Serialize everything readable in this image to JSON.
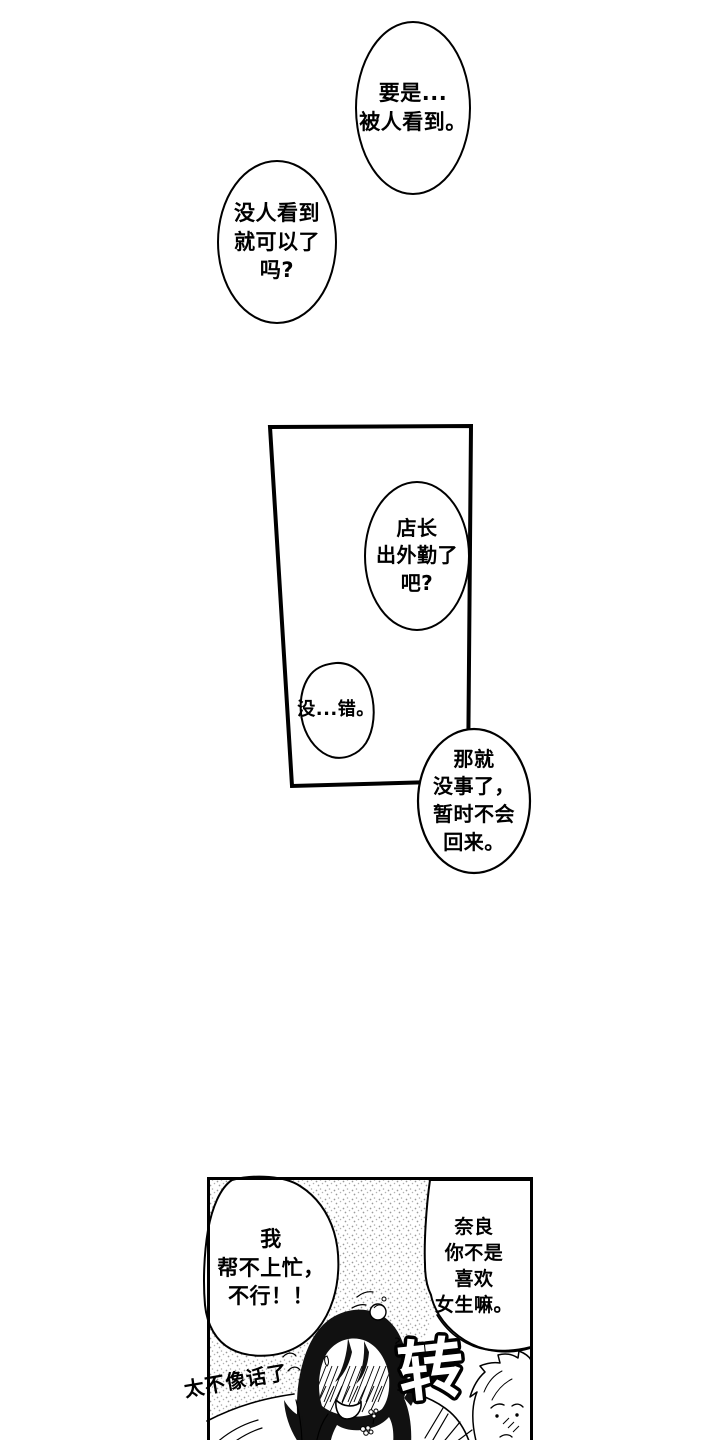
{
  "page": {
    "kind": "manga-page",
    "colors": {
      "paper": "#ffffff",
      "ink": "#000000",
      "stipple_dot": "#9a9a9a"
    }
  },
  "bubbles": {
    "if_seen": {
      "lines": [
        "要是...",
        "被人看到。"
      ]
    },
    "no_one_saw": {
      "lines": [
        "没人看到",
        "就可以了",
        "吗?"
      ]
    },
    "manager_out": {
      "lines": [
        "店长",
        "出外勤了",
        "吧?"
      ]
    },
    "thats_right": {
      "lines": [
        "没...错。"
      ]
    },
    "wont_return": {
      "lines": [
        "那就",
        "没事了，",
        "暂时不会",
        "回来。"
      ]
    },
    "cant_help": {
      "lines": [
        "我",
        "帮不上忙，",
        "不行！！"
      ]
    },
    "nara": {
      "lines": [
        "奈良",
        "你不是",
        "喜欢",
        "女生嘛。"
      ]
    }
  },
  "sfx": {
    "spin": "转",
    "question_marks": [
      "?",
      "?"
    ]
  },
  "handwriting": {
    "mutter": "太不像话了"
  }
}
